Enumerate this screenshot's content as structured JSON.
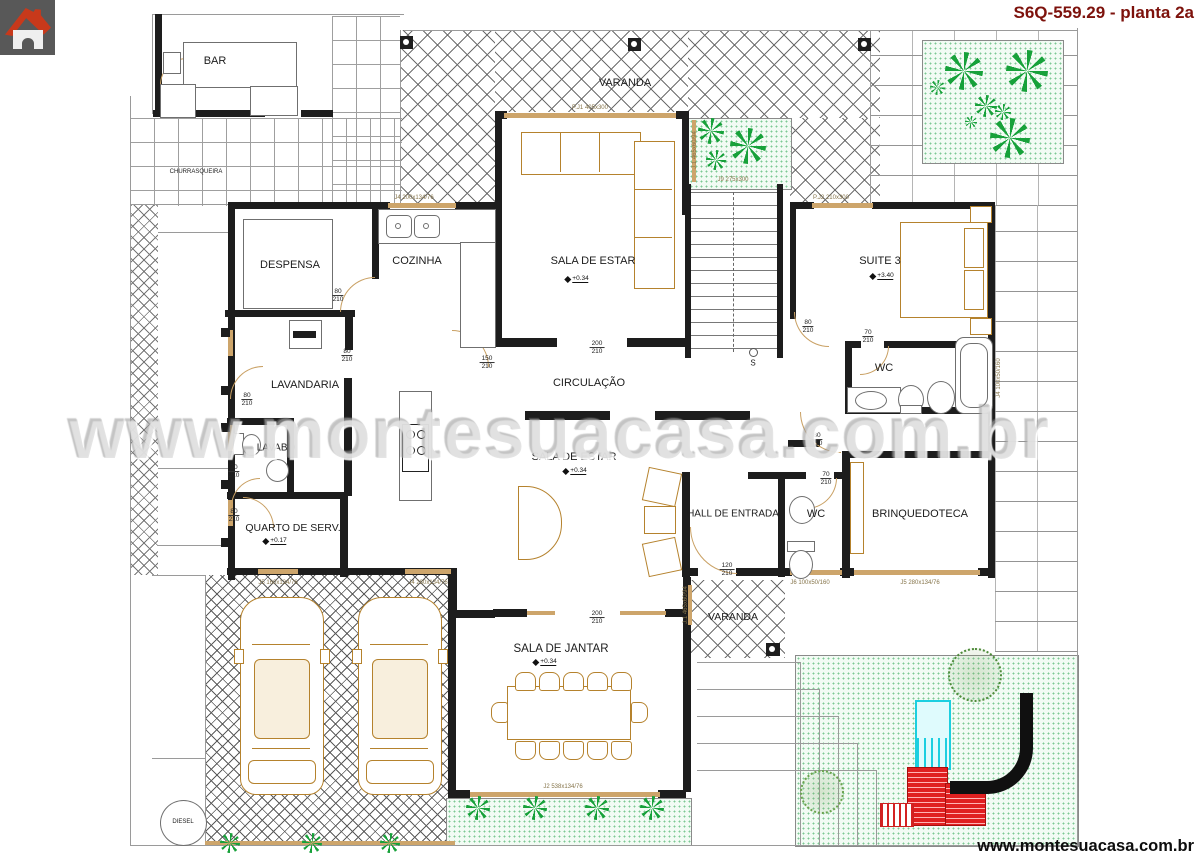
{
  "header": {
    "title": "S6Q-559.29 - planta 2a"
  },
  "footer": {
    "url": "www.montesuacasa.com.br"
  },
  "watermark": {
    "text": "www.montesuacasa.com.br"
  },
  "logo": {
    "icon": "house-logo-icon"
  },
  "colors": {
    "title_red": "#7d120c",
    "furniture_tan": "#b5822d",
    "window_tan": "#cda56b",
    "plant_green": "#17a13a",
    "pool_cyan": "#1ccfe0",
    "structure_red": "#e02020",
    "slide_black": "#101010",
    "wall_black": "#1d1d1d"
  },
  "plan": {
    "rooms": [
      {
        "text": "BAR",
        "x": 215,
        "y": 61,
        "s": 11
      },
      {
        "text": "CHURRASQUEIRA",
        "x": 196,
        "y": 172,
        "s": 6
      },
      {
        "text": "VARANDA",
        "x": 625,
        "y": 83,
        "s": 11
      },
      {
        "text": "SALA DE ESTAR",
        "x": 593,
        "y": 261,
        "s": 11
      },
      {
        "text": "SUITE 3",
        "x": 880,
        "y": 261,
        "s": 11
      },
      {
        "text": "WC",
        "x": 884,
        "y": 368,
        "s": 11
      },
      {
        "text": "DESPENSA",
        "x": 290,
        "y": 265,
        "s": 11
      },
      {
        "text": "COZINHA",
        "x": 417,
        "y": 261,
        "s": 11
      },
      {
        "text": "LAVANDARIA",
        "x": 305,
        "y": 385,
        "s": 11
      },
      {
        "text": "LAVABO",
        "x": 276,
        "y": 448,
        "s": 10
      },
      {
        "text": "CIRCULAÇÃO",
        "x": 589,
        "y": 383,
        "s": 11
      },
      {
        "text": "SALA DE ESTAR",
        "x": 574,
        "y": 457,
        "s": 11
      },
      {
        "text": "QUARTO DE SERV.",
        "x": 293,
        "y": 528,
        "s": 10.5
      },
      {
        "text": "HALL DE ENTRADA",
        "x": 733,
        "y": 514,
        "s": 10
      },
      {
        "text": "WC",
        "x": 816,
        "y": 514,
        "s": 11
      },
      {
        "text": "BRINQUEDOTECA",
        "x": 920,
        "y": 514,
        "s": 11
      },
      {
        "text": "SALA DE JANTAR",
        "x": 561,
        "y": 649,
        "s": 11.5
      },
      {
        "text": "VARANDA",
        "x": 733,
        "y": 617,
        "s": 10.5
      },
      {
        "text": "DIESEL",
        "x": 183,
        "y": 822,
        "s": 6
      },
      {
        "text": "S",
        "x": 753,
        "y": 363,
        "s": 8
      }
    ],
    "levels": [
      {
        "text": "+0.34",
        "x": 577,
        "y": 279
      },
      {
        "text": "+3.40",
        "x": 882,
        "y": 276
      },
      {
        "text": "+0.34",
        "x": 575,
        "y": 471
      },
      {
        "text": "+0.17",
        "x": 275,
        "y": 541
      },
      {
        "text": "+0.34",
        "x": 545,
        "y": 662
      }
    ],
    "dims": [
      {
        "w": "80",
        "h": "210",
        "x": 338,
        "y": 296
      },
      {
        "w": "80",
        "h": "210",
        "x": 347,
        "y": 356
      },
      {
        "w": "80",
        "h": "210",
        "x": 247,
        "y": 400
      },
      {
        "w": "70",
        "h": "210",
        "x": 234,
        "y": 472
      },
      {
        "w": "80",
        "h": "210",
        "x": 234,
        "y": 516
      },
      {
        "w": "150",
        "h": "210",
        "x": 487,
        "y": 363
      },
      {
        "w": "200",
        "h": "210",
        "x": 597,
        "y": 348
      },
      {
        "w": "200",
        "h": "210",
        "x": 597,
        "y": 618
      },
      {
        "w": "80",
        "h": "210",
        "x": 808,
        "y": 327
      },
      {
        "w": "70",
        "h": "210",
        "x": 868,
        "y": 337
      },
      {
        "w": "80",
        "h": "210",
        "x": 817,
        "y": 440
      },
      {
        "w": "70",
        "h": "210",
        "x": 826,
        "y": 479
      },
      {
        "w": "120",
        "h": "210",
        "x": 727,
        "y": 570
      }
    ],
    "windows": [
      {
        "text": "P.J1 405x300",
        "x": 590,
        "y": 108
      },
      {
        "text": "J4 200x134/76",
        "x": 414,
        "y": 198
      },
      {
        "text": "P.J2 210x300",
        "x": 831,
        "y": 198
      },
      {
        "text": "J9 275x300",
        "x": 733,
        "y": 180
      },
      {
        "text": "J.1 465x60/94",
        "x": 695,
        "y": 150,
        "v": 1
      },
      {
        "text": "J.1 465x60/94",
        "x": 686,
        "y": 605,
        "v": 1
      },
      {
        "text": "J4 100x50/160",
        "x": 999,
        "y": 378,
        "v": 1
      },
      {
        "text": "J6 100x50/160",
        "x": 810,
        "y": 583
      },
      {
        "text": "J5 280x134/76",
        "x": 920,
        "y": 583
      },
      {
        "text": "J2 538x134/76",
        "x": 563,
        "y": 787
      },
      {
        "text": "J5 160x134/76",
        "x": 278,
        "y": 583
      },
      {
        "text": "J4 280x134/76",
        "x": 428,
        "y": 583
      }
    ]
  }
}
